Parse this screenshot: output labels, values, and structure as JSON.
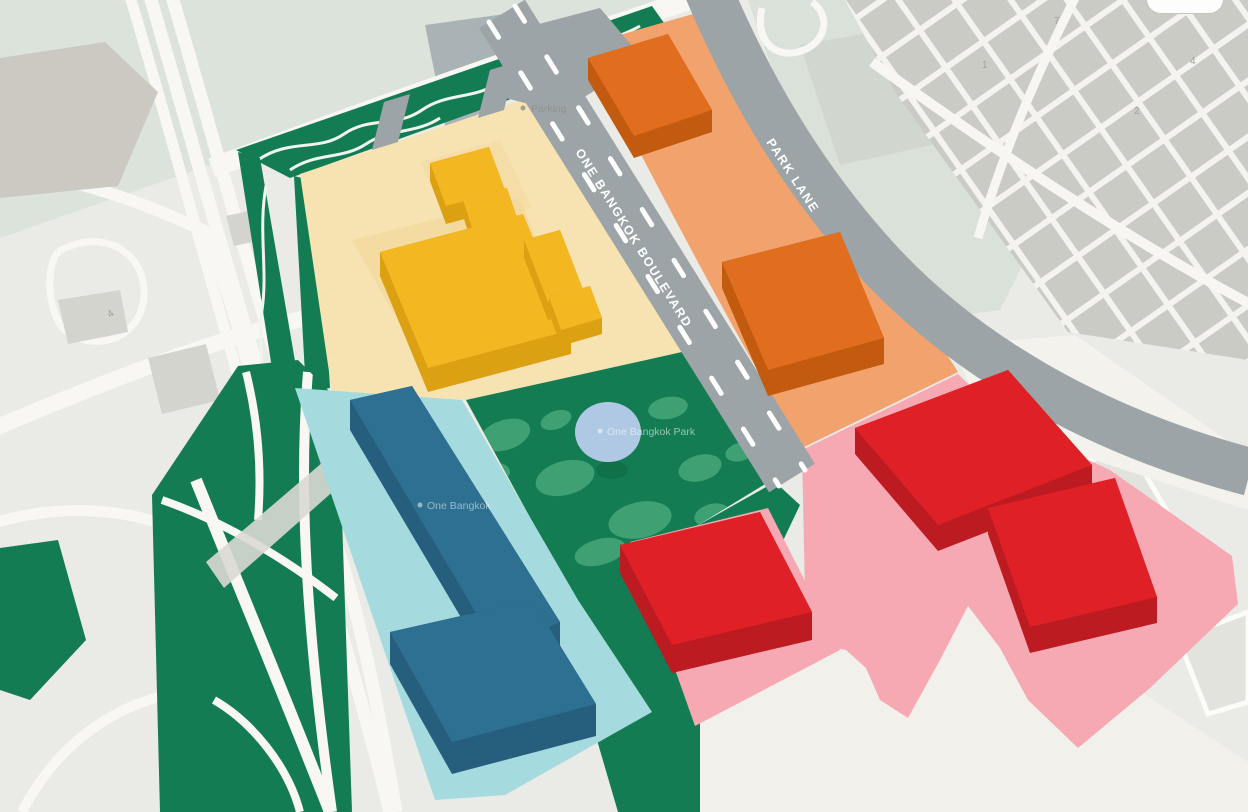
{
  "map": {
    "roads": {
      "boulevard": "ONE BANGKOK BOULEVARD",
      "park_lane": "PARK LANE"
    },
    "pois": {
      "parking": "Parking",
      "park": "One Bangkok Park",
      "building": "One Bangkok"
    },
    "street_numbers": [
      "7",
      "1",
      "4",
      "2",
      "4"
    ],
    "colors": {
      "bg": "#EAEAE6",
      "pale_green": "#DCE3DB",
      "pale_green_2": "#D9E1D8",
      "city_block": "#CBCBC5",
      "white_road": "#F8F7F3",
      "road_gray": "#9CA4A7",
      "road_marking": "#FFFFFF",
      "site_green": "#147C52",
      "camo_green": "#3FA173",
      "pond_blue": "#AFC9E4",
      "cream_zone": "#F7E2B2",
      "cream_patch": "#F2D695",
      "yellow_top": "#F3B722",
      "yellow_side": "#DCA013",
      "orange_zone": "#F2A26C",
      "orange_top": "#E06E1E",
      "orange_side": "#C25A10",
      "pink_zone": "#F6A9B3",
      "red_top": "#DF2127",
      "red_side": "#BC1B21",
      "teal_zone": "#A5DADE",
      "teal_top": "#2E7092",
      "teal_side": "#265E7D",
      "cream_bottom": "#F2F0EA",
      "gray_shape": "#CBC9C2",
      "bluegray_shape": "#A9B3B6"
    }
  }
}
